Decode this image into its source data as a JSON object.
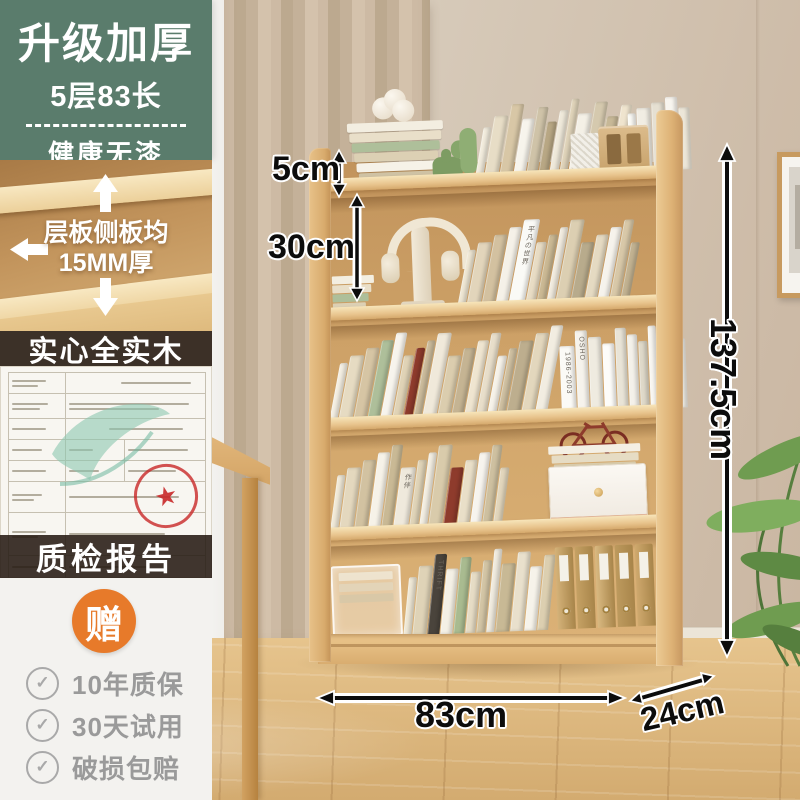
{
  "sidebar": {
    "promo": {
      "title": "升级加厚",
      "subtitle": "5层83长",
      "tagline": "健康无漆"
    },
    "thickness_note": {
      "line1": "层板侧板均",
      "line2": "15MM厚"
    },
    "solid_wood_label": "实心全实木",
    "report_label": "质检报告",
    "gift_badge": "赠",
    "benefits": [
      {
        "label": "10年质保"
      },
      {
        "label": "30天试用"
      },
      {
        "label": "破损包赔"
      }
    ]
  },
  "dimensions": {
    "top_gap": "5cm",
    "first_shelf": "30cm",
    "height": "137.5cm",
    "width": "83cm",
    "depth": "24cm"
  },
  "colors": {
    "promo_green": "#5a7c6c",
    "dark_bar": "#261a12",
    "gift_orange": "#e77a2a",
    "benefit_gray": "#9a9a9a",
    "wood": "#ddb178",
    "accent_red": "#8e3b2c",
    "stamp_red": "#c82828",
    "leaf_teal": "#8cc7b0"
  },
  "decor": {
    "spine_labels": {
      "s1": "平凡の世界",
      "s2a": "1986-2003",
      "s2b": "OSHO",
      "s3": "作伴",
      "s4": "THRIFT"
    }
  },
  "books": {
    "stack": [
      "#f3eee1",
      "#e9dfc9",
      "#aebf9a",
      "#dcd0b4",
      "#f6f2e8",
      "#cfc2a4"
    ],
    "row_top": [
      "#f2ecdd",
      "#e7ddc6",
      "#d8c7a6",
      "#f7f4ec",
      "#cfc3a8",
      "#b8a784",
      "#efe9da",
      "#e0d4ba",
      "#f4f0e6",
      "#d5c9ae",
      "#c7b897",
      "#efe4ce"
    ],
    "row_top_white": [
      "#fbfaf5",
      "#f1ede3",
      "#e6e0d2",
      "#f8f5ef",
      "#ece6d8"
    ],
    "row1": [
      "#efe7d4",
      "#e2d5bb",
      "#d3c1a0",
      "#f5f1e8",
      {
        "c": "#fafaf6",
        "label": "s1",
        "w": 16
      },
      "#e8dcc4",
      "#cbb994",
      "#f1ebdf",
      "#dccfb2",
      "#b8ab8c",
      "#e5dac2",
      "#f6f3ec",
      "#d8c8a8",
      "#c2b291"
    ],
    "row2_lean": [
      "#f4efe3",
      "#e6dbc2",
      "#d6c5a4",
      "#aebf9a",
      "#f7f4ed",
      "#e0d3b6",
      "#8e3b2c",
      "#ccbc9c",
      "#f0e9da",
      "#dbcdae",
      "#c5b493",
      "#efe5d0",
      "#e8deca",
      "#f6f2e9",
      "#d0c1a2",
      "#bdae8e",
      "#e3d7bd",
      "#f2ede1"
    ],
    "row2_upright": [
      {
        "c": "#fbfaf6",
        "label": "s2a",
        "w": 15
      },
      {
        "c": "#f6f3ec",
        "label": "s2b",
        "w": 12
      },
      "#efebe0",
      "#fdfcf9",
      "#e9e4d7",
      "#f4f1ea",
      "#dfd9c9",
      "#f8f6f1",
      "#ebe6da",
      "#f1eee6"
    ],
    "row3": [
      "#f1ead9",
      "#e4d8be",
      "#d2c2a1",
      "#f6f2e8",
      "#c9b995",
      {
        "c": "#efe9dc",
        "label": "s3",
        "w": 15
      },
      "#e0d4b8",
      "#f3eee2",
      "#d9cbab",
      "#8e3b2c",
      "#e9dfc8",
      "#f7f4ee",
      "#cec0a0",
      "#e2d6bc"
    ],
    "row4": [
      "#efe8d6",
      "#dfd3b7",
      {
        "c": "#4a443c",
        "label": "s4",
        "w": 12
      },
      "#f4f0e5",
      "#a9bb90",
      "#e6dcc5",
      "#d3c5a5",
      "#f0ebdf",
      "#c8b995",
      "#e9e0cc",
      "#f6f3ea",
      "#dccfb0"
    ],
    "binders": [
      "#d4b279",
      "#c5a164",
      "#d9b981",
      "#bd9a5e",
      "#cfa96e"
    ]
  }
}
